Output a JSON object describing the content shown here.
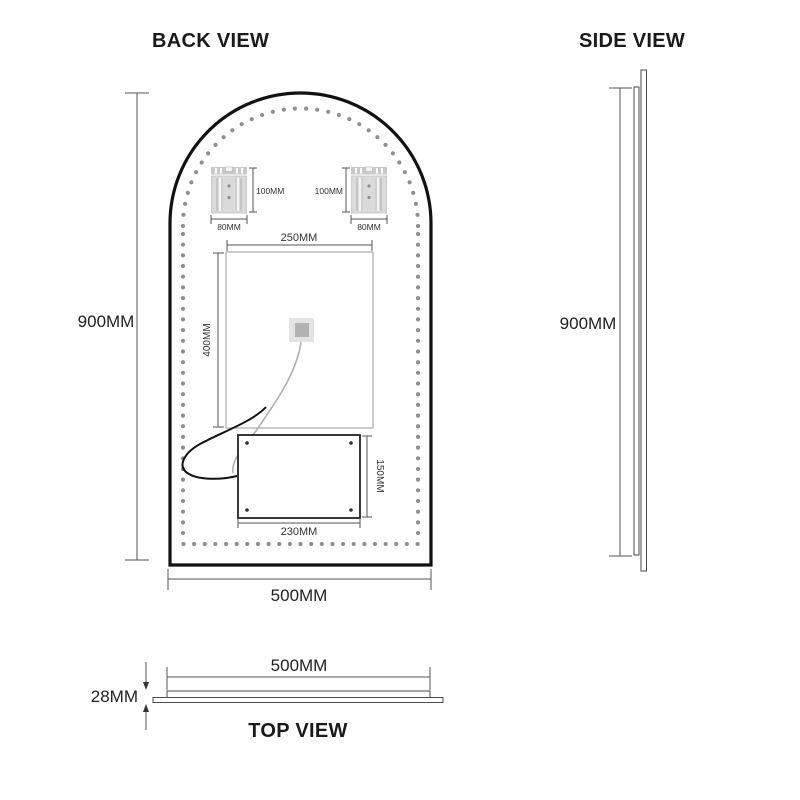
{
  "drawing": {
    "back_view": {
      "title": "BACK VIEW",
      "overall_height": "900MM",
      "overall_width": "500MM",
      "led_panel": {
        "width": "250MM",
        "height": "400MM"
      },
      "bracket_left": {
        "height": "100MM",
        "width": "80MM"
      },
      "bracket_right": {
        "height": "100MM",
        "width": "80MM"
      },
      "junction_box": {
        "width": "230MM",
        "height": "150MM"
      }
    },
    "side_view": {
      "title": "SIDE VIEW",
      "overall_height": "900MM"
    },
    "top_view": {
      "title": "TOP VIEW",
      "overall_width": "500MM",
      "thickness": "28MM"
    }
  },
  "colors": {
    "outline": "#111111",
    "dim_line": "#555555",
    "led_dot": "#8f8f8f",
    "bracket_fill": "#dadada",
    "bracket_rail": "#c9c9c9",
    "sensor_outer": "#e4e4e4",
    "sensor_inner": "#b2b2b2",
    "wire_black": "#111111",
    "wire_grey": "#b0b0b0",
    "background": "#ffffff"
  },
  "dots": {
    "bottom": {
      "y": 544,
      "x_start": 183.5,
      "count": 23,
      "step": 10.64
    },
    "sides": {
      "x_left": 183,
      "x_right": 418,
      "y_start": 234,
      "count": 29,
      "step": 10.68
    },
    "arc": {
      "cx": 300.5,
      "cy": 226,
      "r": 117.5,
      "count": 34
    },
    "radius": 2.1
  }
}
